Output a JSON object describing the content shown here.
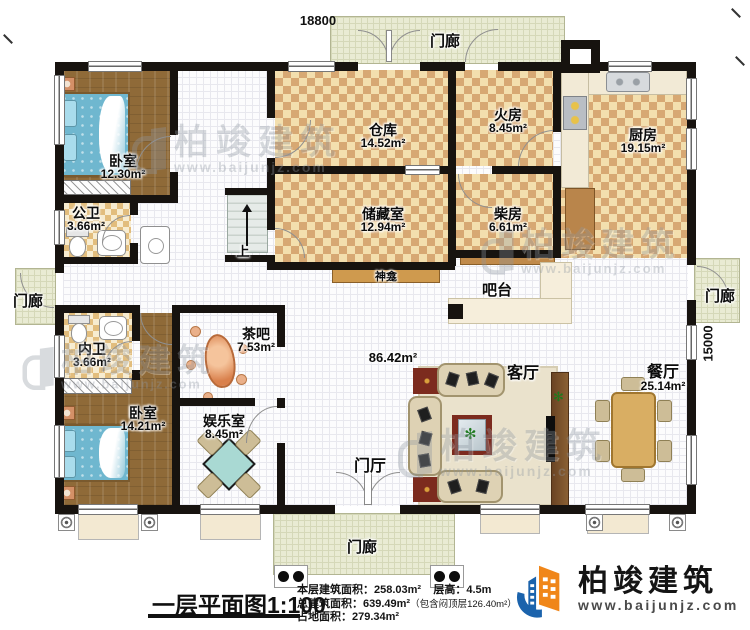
{
  "dimensions": {
    "top": "18800",
    "right": "15000"
  },
  "rooms": [
    {
      "name": "卧室",
      "area": "12.30m²"
    },
    {
      "name": "公卫",
      "area": "3.66m²"
    },
    {
      "name": "仓库",
      "area": "14.52m²"
    },
    {
      "name": "火房",
      "area": "8.45m²"
    },
    {
      "name": "厨房",
      "area": "19.15m²"
    },
    {
      "name": "储藏室",
      "area": "12.94m²"
    },
    {
      "name": "柴房",
      "area": "6.61m²"
    },
    {
      "name": "内卫",
      "area": "3.66m²"
    },
    {
      "name": "茶吧",
      "area": "7.53m²"
    },
    {
      "name": "卧室",
      "area": "14.21m²"
    },
    {
      "name": "娱乐室",
      "area": "8.45m²"
    },
    {
      "name": "餐厅",
      "area": "25.14m²"
    }
  ],
  "labels": {
    "living_room": "客厅",
    "hall_area": "86.42m²",
    "foyer": "门厅",
    "bar_counter": "吧台",
    "shrine": "神龛",
    "stairs_up": "上",
    "porch": "门廊"
  },
  "footer": {
    "title": "一层平面图1:100",
    "floor_area": "本层建筑面积：258.03m²",
    "floor_height": "层高：4.5m",
    "total_area": "总建筑面积：639.49m²",
    "total_area_note": "（包含闷顶层126.40m²）",
    "land_area": "占地面积：279.34m²"
  },
  "brand": {
    "name": "柏竣建筑",
    "website": "www.baijunjz.com"
  },
  "watermark": {
    "name": "柏竣建筑",
    "website": "www.baijunjz.com"
  },
  "colors": {
    "wall": "#17130f",
    "brand_blue": "#1b63ac",
    "brand_orange": "#f08619"
  }
}
